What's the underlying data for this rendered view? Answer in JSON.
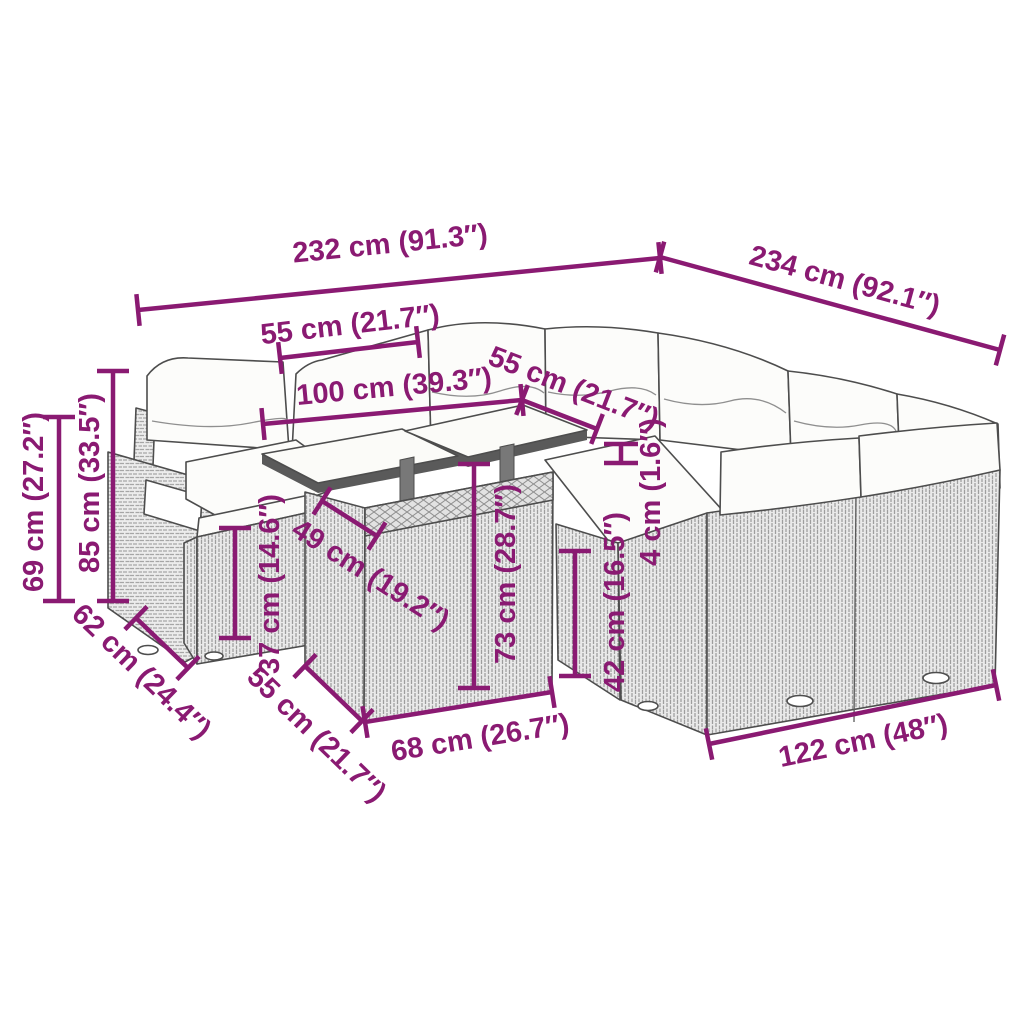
{
  "diagram": {
    "type": "product-dimension-diagram",
    "description": "Line-art dimension drawing of a poly rattan garden lounge set: armchair, footstools, table with two glass top panels and corner sofa with cushions, annotated with magenta measurements"
  },
  "colors": {
    "dimension_accent": "#8A1A72",
    "line_art": "#4D4D4D",
    "rattan_fill": "#ECECEC",
    "cushion_fill": "#FCFCFA",
    "background": "#FFFFFF"
  },
  "dimensions": [
    {
      "id": "back-total-width",
      "label": "232 cm (91.3″)"
    },
    {
      "id": "right-total-depth",
      "label": "234 cm (92.1″)"
    },
    {
      "id": "left-seat-width",
      "label": "55 cm (21.7″)"
    },
    {
      "id": "table-top-length",
      "label": "100 cm (39.3″)"
    },
    {
      "id": "right-seat-width",
      "label": "55 cm (21.7″)"
    },
    {
      "id": "armrest-height",
      "label": "69 cm (27.2″)"
    },
    {
      "id": "backrest-height",
      "label": "85 cm (33.5″)"
    },
    {
      "id": "armchair-depth",
      "label": "62 cm (24.4″)"
    },
    {
      "id": "footstool-height",
      "label": "37 cm (14.6″)"
    },
    {
      "id": "table-top-depth",
      "label": "49 cm (19.2″)"
    },
    {
      "id": "table-height",
      "label": "73 cm (28.7″)"
    },
    {
      "id": "seat-height",
      "label": "42 cm (16.5″)"
    },
    {
      "id": "cushion-thickness",
      "label": "4 cm (1.6″)"
    },
    {
      "id": "table-base-depth",
      "label": "55 cm (21.7″)"
    },
    {
      "id": "table-base-width",
      "label": "68 cm (26.7″)"
    },
    {
      "id": "sofa-front-width",
      "label": "122 cm (48″)"
    }
  ]
}
